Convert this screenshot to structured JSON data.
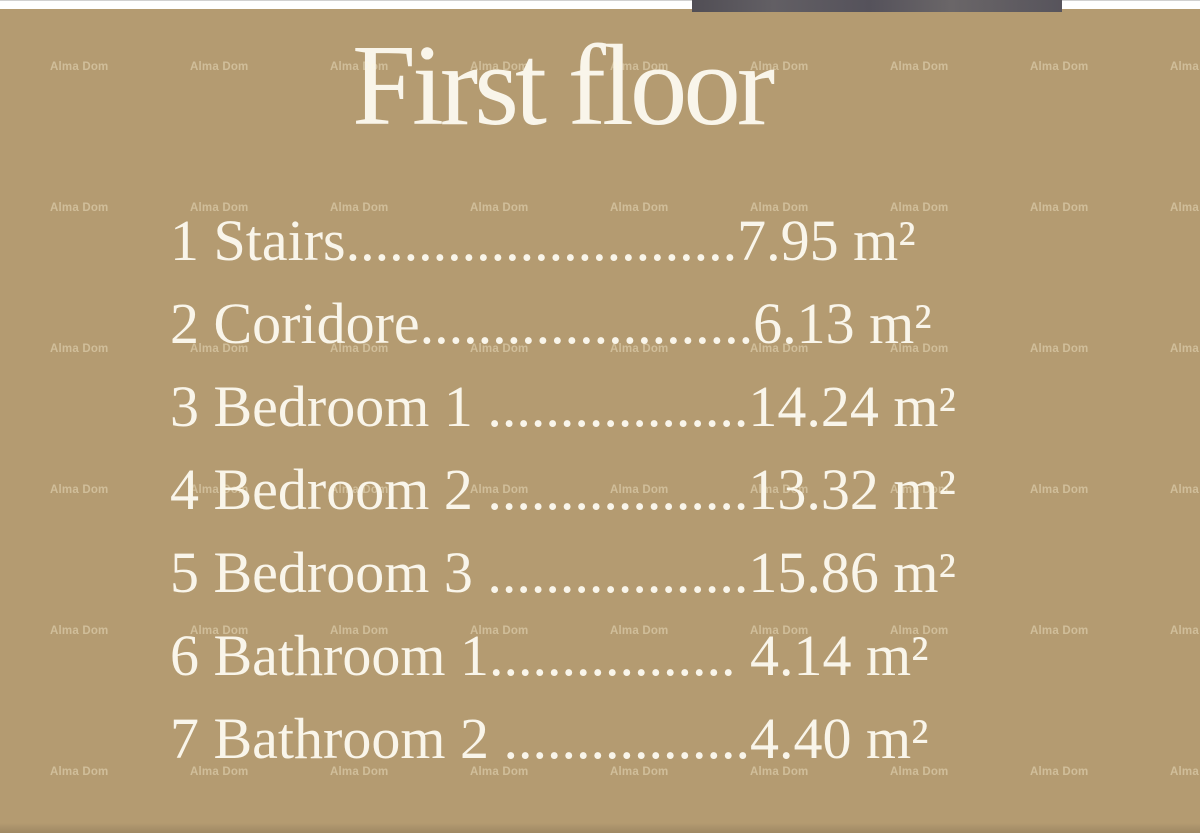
{
  "title": "First floor",
  "watermark": {
    "text": "Alma Dom"
  },
  "rooms": [
    {
      "label": "1 Stairs",
      "dots": "...........................",
      "area": "7.95 m²"
    },
    {
      "label": "2 Coridore",
      "dots": ".......................",
      "area": "6.13 m²"
    },
    {
      "label": "3 Bedroom 1 ",
      "dots": "..................",
      "area": "14.24 m²"
    },
    {
      "label": "4 Bedroom 2 ",
      "dots": "..................",
      "area": "13.32 m²"
    },
    {
      "label": "5 Bedroom 3 ",
      "dots": "..................",
      "area": "15.86 m²"
    },
    {
      "label": "6 Bathroom 1",
      "dots": ".................",
      "area": " 4.14 m²"
    },
    {
      "label": "7 Bathroom 2 ",
      "dots": ".................",
      "area": "4.40 m²"
    }
  ]
}
